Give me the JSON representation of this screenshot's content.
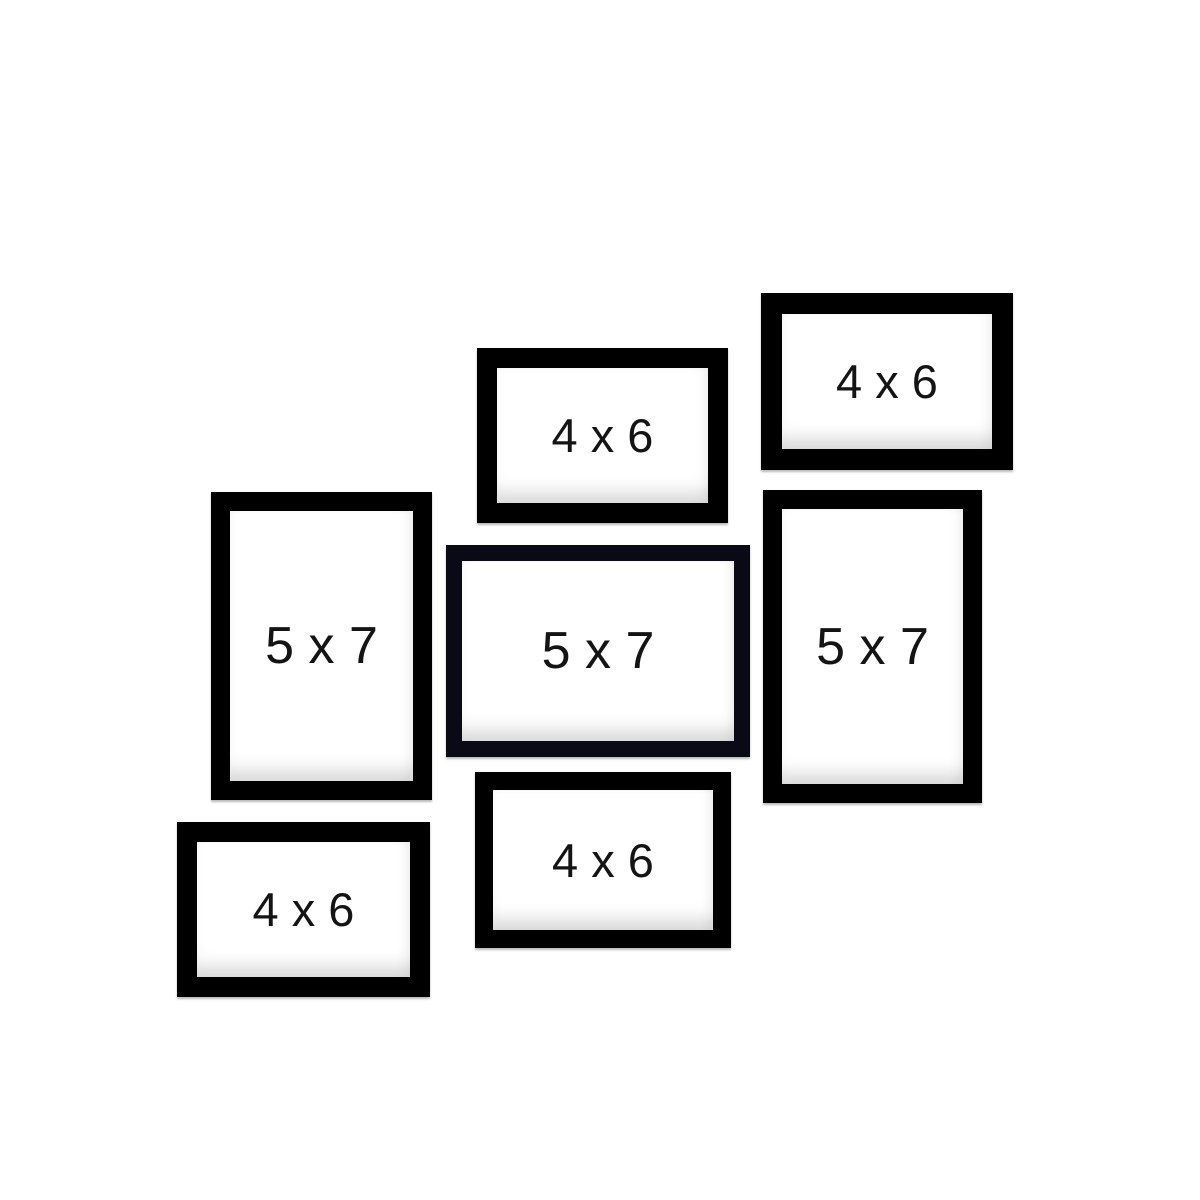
{
  "collage": {
    "background_color": "#ffffff",
    "frame_border_color": "#000000",
    "center_frame_border_color": "#0a0a16",
    "label_text_color": "#141414",
    "frame_count": 7
  },
  "frames": [
    {
      "name": "top-right-4x6",
      "label": "4 x 6",
      "size": "4x6",
      "orientation": "landscape"
    },
    {
      "name": "top-middle-4x6",
      "label": "4 x 6",
      "size": "4x6",
      "orientation": "landscape"
    },
    {
      "name": "left-5x7",
      "label": "5 x 7",
      "size": "5x7",
      "orientation": "portrait"
    },
    {
      "name": "center-5x7",
      "label": "5 x 7",
      "size": "5x7",
      "orientation": "landscape"
    },
    {
      "name": "right-5x7",
      "label": "5 x 7",
      "size": "5x7",
      "orientation": "portrait"
    },
    {
      "name": "bottom-middle-4x6",
      "label": "4 x 6",
      "size": "4x6",
      "orientation": "landscape"
    },
    {
      "name": "bottom-left-4x6",
      "label": "4 x 6",
      "size": "4x6",
      "orientation": "landscape"
    }
  ]
}
